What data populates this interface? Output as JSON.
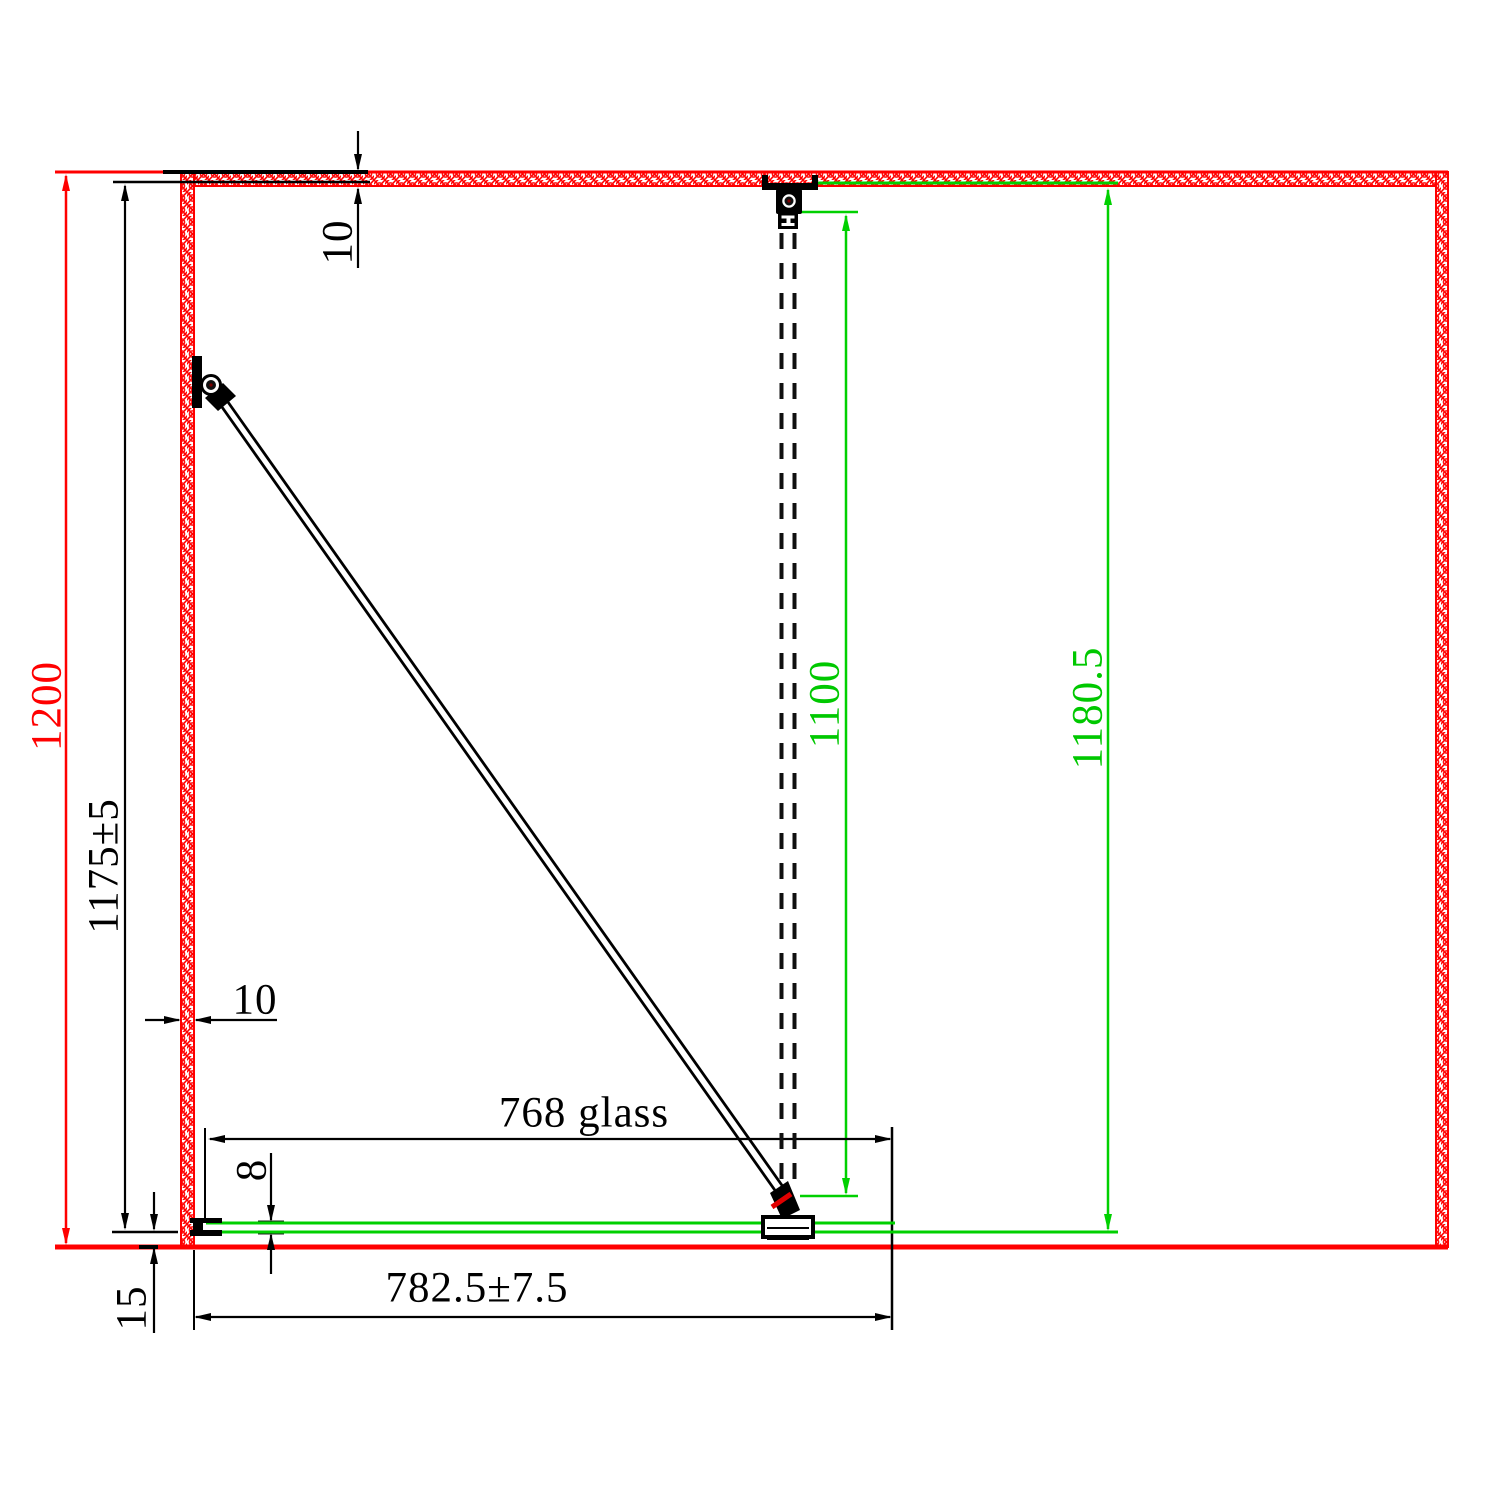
{
  "colors": {
    "wall_red": "#ff0000",
    "glass_green": "#00d000",
    "dimension_black": "#000000",
    "background": "#ffffff"
  },
  "dimensions": {
    "room_depth": "1200",
    "panel_depth_tolerance": "1175±5",
    "top_wall_thickness": "10",
    "side_wall_thickness": "10",
    "support_bar_length": "1100",
    "panel_total_depth": "1180.5",
    "glass_width": "768 glass",
    "total_width": "782.5±7.5",
    "glass_thickness": "8",
    "floor_gap": "15"
  }
}
